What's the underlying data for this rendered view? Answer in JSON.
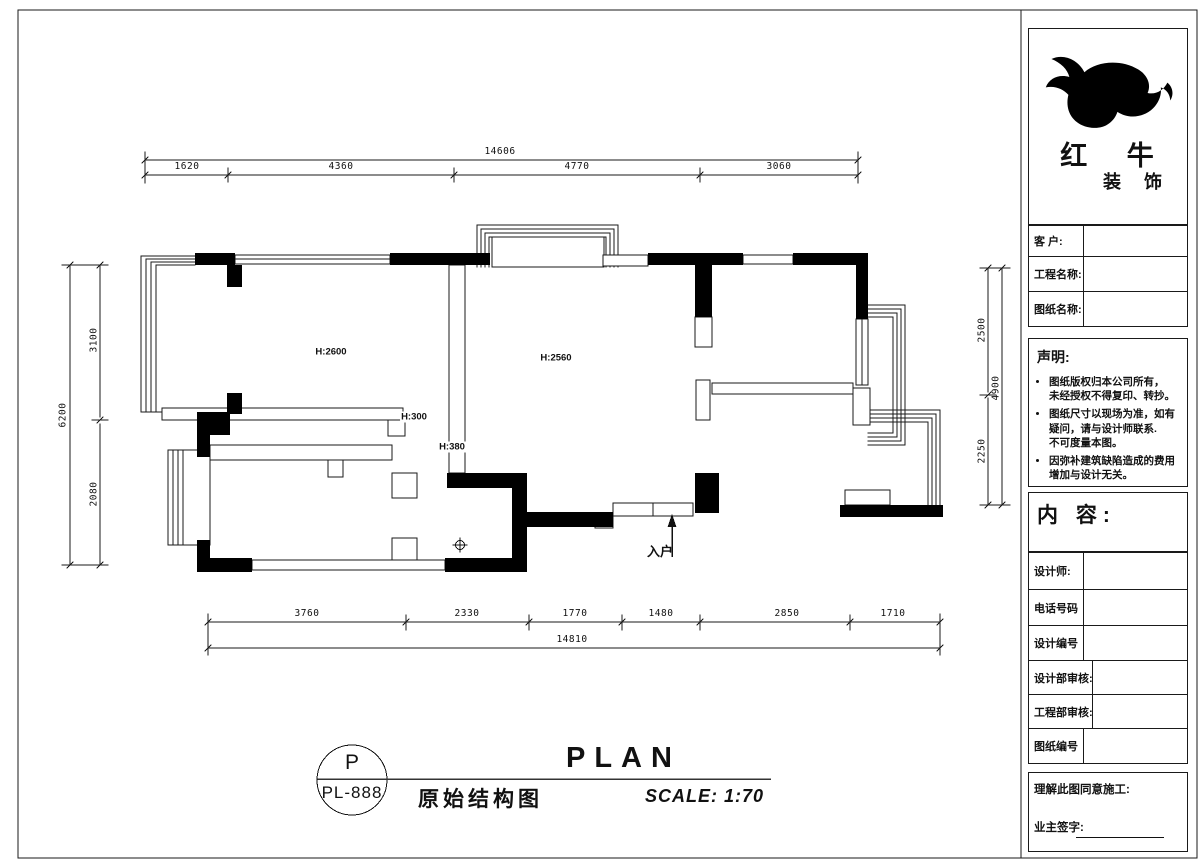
{
  "brand": {
    "name_line1": "红 牛",
    "name_line2": "装 饰"
  },
  "title_block": {
    "fields_top": [
      {
        "label": "客  户:"
      },
      {
        "label": "工程名称:"
      },
      {
        "label": "图纸名称:"
      }
    ],
    "statement": {
      "title": "声明:",
      "bullets": [
        "图纸版权归本公司所有，\n未经授权不得复印、转抄。",
        "图纸尺寸以现场为准，如有\n疑问，请与设计师联系.\n不可度量本图。",
        "因弥补建筑缺陷造成的费用\n增加与设计无关。"
      ]
    },
    "content_label": "内 容:",
    "fields_bottom": [
      {
        "label": "设计师:"
      },
      {
        "label": "电话号码"
      },
      {
        "label": "设计编号"
      },
      {
        "label": "设计部审核:"
      },
      {
        "label": "工程部审核:"
      },
      {
        "label": "图纸编号"
      }
    ],
    "footer": {
      "line1": "理解此图同意施工:",
      "line2": "业主签字:"
    }
  },
  "plan": {
    "rooms": [
      "H:2600",
      "H:2560",
      "H:300",
      "H:380"
    ],
    "entry_label": "入户",
    "dims": {
      "top_total": "14606",
      "top": [
        "1620",
        "4360",
        "4770",
        "3060"
      ],
      "bottom": [
        "3760",
        "2330",
        "1770",
        "1480",
        "2850",
        "1710"
      ],
      "bottom_total": "14810",
      "left_total": "6200",
      "left": [
        "3100",
        "2080"
      ],
      "right": [
        "2500",
        "2250"
      ],
      "right_total": "4900"
    }
  },
  "title_bar": {
    "code_top": "P",
    "code_bottom": "PL-888",
    "title_cn": "原始结构图",
    "title_en": "PLAN",
    "scale": "SCALE: 1:70"
  }
}
